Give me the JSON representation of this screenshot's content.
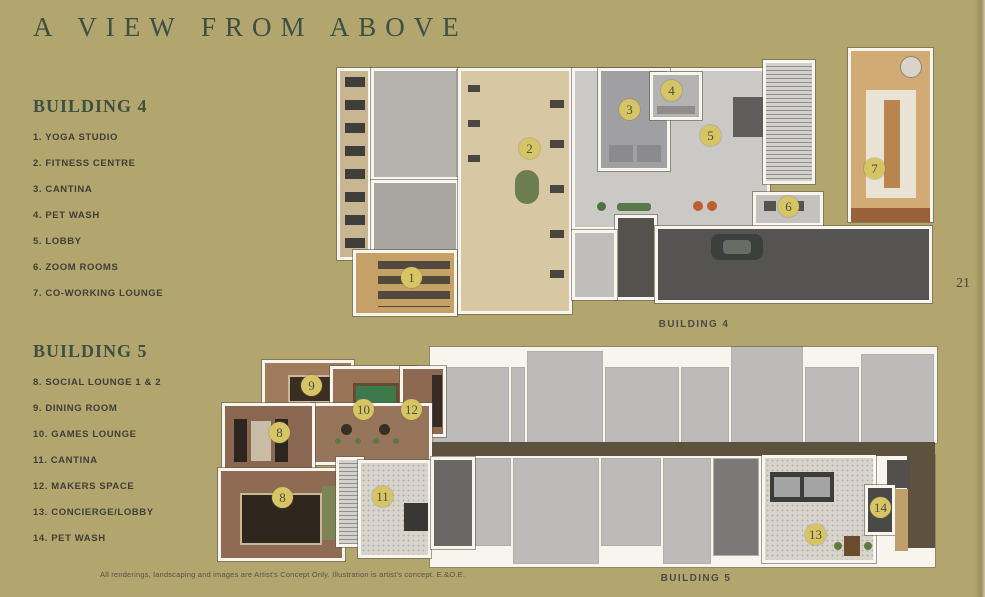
{
  "title": "A VIEW FROM ABOVE",
  "page_number": "21",
  "disclaimer": "All renderings, landscaping and images are Artist's Concept Only.  Illustration is artist's concept. E.&O.E.",
  "colors": {
    "background": "#b2a56e",
    "heading_green": "#3e5041",
    "legend_text": "#3f3e38",
    "marker_fill": "#d7c465",
    "marker_text": "#49533e",
    "corridor_brown": "#5e523e",
    "amenity_wood": "#97755a",
    "unit_gray": "#bcbbba",
    "driveway_gray": "#565452"
  },
  "legends": [
    {
      "name": "BUILDING 4",
      "items": [
        "1. YOGA STUDIO",
        "2. FITNESS CENTRE",
        "3. CANTINA",
        "4. PET WASH",
        "5. LOBBY",
        "6. ZOOM ROOMS",
        "7. CO-WORKING LOUNGE"
      ]
    },
    {
      "name": "BUILDING 5",
      "items": [
        "8. SOCIAL LOUNGE 1 & 2",
        "9. DINING ROOM",
        "10. GAMES LOUNGE",
        "11. CANTINA",
        "12. MAKERS SPACE",
        "13. CONCIERGE/LOBBY",
        "14. PET WASH"
      ]
    }
  ],
  "plans": [
    {
      "caption": "BUILDING 4",
      "markers": [
        "1",
        "2",
        "3",
        "4",
        "5",
        "6",
        "7"
      ]
    },
    {
      "caption": "BUILDING 5",
      "markers": [
        "9",
        "10",
        "12",
        "8",
        "8",
        "11",
        "13",
        "14"
      ]
    }
  ]
}
